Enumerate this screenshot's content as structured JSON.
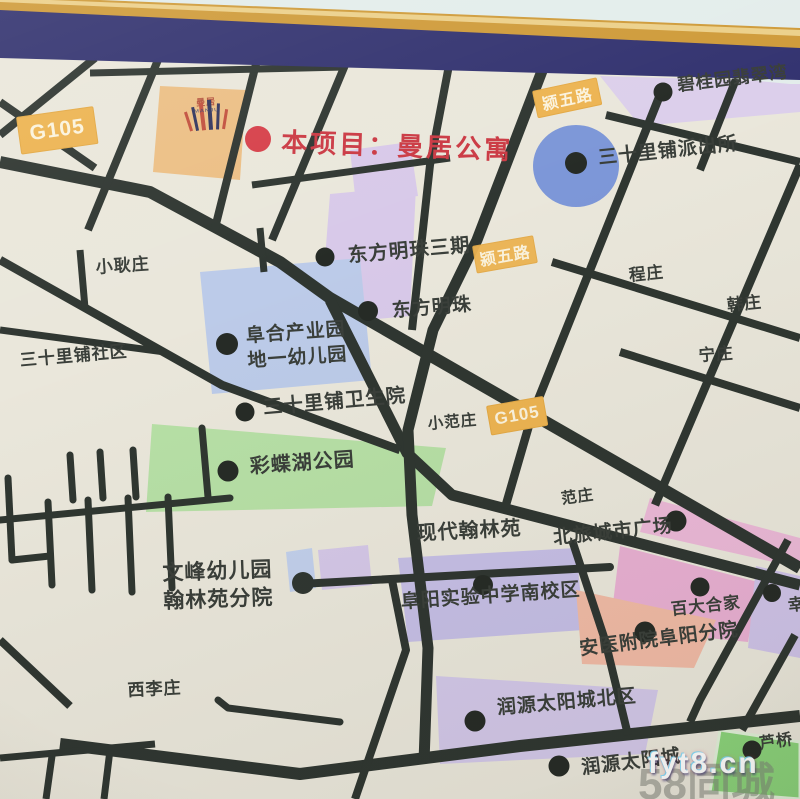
{
  "title": "楼盘区位地图",
  "project": {
    "marker_label": "本项目：曼居公寓",
    "logo_name": "曼居",
    "logo_sub": "MANJU"
  },
  "badges": [
    {
      "id": "g105-west",
      "text": "G105"
    },
    {
      "id": "yingwu-road-north",
      "text": "颍五路"
    },
    {
      "id": "yingwu-road-mid",
      "text": "颍五路"
    },
    {
      "id": "g105-mid",
      "text": "G105"
    }
  ],
  "labels": [
    {
      "id": "biguiyuan-feicuiwan",
      "text": "碧桂园翡翠湾"
    },
    {
      "id": "sanshilipu-police-station",
      "text": "三十里铺派出所"
    },
    {
      "id": "dongfang-mingzhu-phase3",
      "text": "东方明珠三期"
    },
    {
      "id": "chengzhuang",
      "text": "程庄"
    },
    {
      "id": "hanzhuang",
      "text": "韩庄"
    },
    {
      "id": "dongfang-mingzhu",
      "text": "东方明珠"
    },
    {
      "id": "xiaogengzhuang",
      "text": "小耿庄"
    },
    {
      "id": "ningzhuang",
      "text": "宁庄"
    },
    {
      "id": "sanshilipu-shequ",
      "text": "三十里铺社区"
    },
    {
      "id": "fuhe-industrial-park-kindergarten",
      "text": "阜合产业园\n地一幼儿园"
    },
    {
      "id": "sanshilipu-clinic",
      "text": "三十里铺卫生院"
    },
    {
      "id": "xiaofanzhuang",
      "text": "小范庄"
    },
    {
      "id": "caidiehu-park",
      "text": "彩蝶湖公园"
    },
    {
      "id": "fanzhuang",
      "text": "范庄"
    },
    {
      "id": "xiandai-hanlinyuan",
      "text": "现代翰林苑"
    },
    {
      "id": "beilv-city-plaza",
      "text": "北旅城市广场"
    },
    {
      "id": "wenfeng-kindergarten-hanlinyuan",
      "text": "文峰幼儿园\n翰林苑分院"
    },
    {
      "id": "fuyang-shiyan-middle-school-south",
      "text": "阜阳实验中学南校区"
    },
    {
      "id": "baida-hejia",
      "text": "百大合家"
    },
    {
      "id": "xing-partial",
      "text": "幸"
    },
    {
      "id": "anyi-fuyuan-hospital",
      "text": "安医附院阜阳分院"
    },
    {
      "id": "xilizhuang",
      "text": "西李庄"
    },
    {
      "id": "runyuan-sun-city-north",
      "text": "润源太阳城北区"
    },
    {
      "id": "runyuan-sun-city",
      "text": "润源太阳城"
    },
    {
      "id": "luqiao",
      "text": "芦桥"
    }
  ],
  "watermarks": {
    "site": "fyt8.cn",
    "portal": "58同城"
  },
  "colors": {
    "map_background": "#eae7db",
    "road": "#2f3631",
    "frame_navy": "#333370",
    "frame_gold": "#cf9b3a",
    "wall": "#e3edeb",
    "badge_orange": "#edb452",
    "project_red": "#cb3a44",
    "parcel_orange": "#ecbf85",
    "parcel_lavender": "#d8c9e9",
    "parcel_blue": "#bccbe9",
    "parcel_green": "#b7e0a6",
    "parcel_pink": "#ecb9d8",
    "parcel_salmon": "#f1bba6",
    "police_circle_blue": "#7d97d8",
    "parcel_green_bright": "#8bd47b"
  }
}
